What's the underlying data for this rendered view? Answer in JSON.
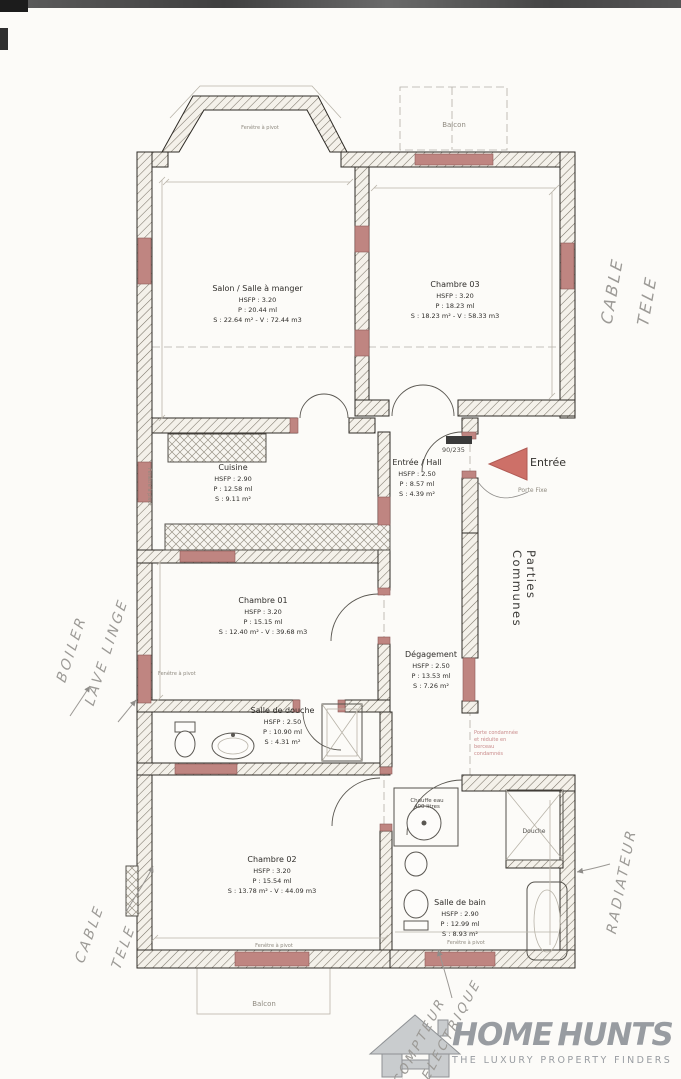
{
  "plan": {
    "rooms": [
      {
        "name": "Salon / Salle à manger",
        "hsfp": "HSFP : 3.20",
        "p": "P : 20.44 ml",
        "sv": "S : 22.64 m² - V : 72.44 m3"
      },
      {
        "name": "Chambre 03",
        "hsfp": "HSFP : 3.20",
        "p": "P : 18.23 ml",
        "sv": "S : 18.23 m² - V : 58.33 m3"
      },
      {
        "name": "Cuisine",
        "hsfp": "HSFP : 2.90",
        "p": "P : 12.58 ml",
        "sv": "S : 9.11 m²"
      },
      {
        "name": "Entrée / Hall",
        "hsfp": "HSFP : 2.50",
        "p": "P : 8.57 ml",
        "sv": "S : 4.39 m²"
      },
      {
        "name": "Chambre 01",
        "hsfp": "HSFP : 3.20",
        "p": "P : 15.15 ml",
        "sv": "S : 12.40 m² - V : 39.68 m3"
      },
      {
        "name": "Dégagement",
        "hsfp": "HSFP : 2.50",
        "p": "P : 13.53 ml",
        "sv": "S : 7.26 m²"
      },
      {
        "name": "Salle de douche",
        "hsfp": "HSFP : 2.50",
        "p": "P : 10.90 ml",
        "sv": "S : 4.31 m²"
      },
      {
        "name": "Chambre 02",
        "hsfp": "HSFP : 3.20",
        "p": "P : 15.54 ml",
        "sv": "S : 13.78 m² - V : 44.09 m3"
      },
      {
        "name": "Salle de bain",
        "hsfp": "HSFP : 2.90",
        "p": "P : 12.99 ml",
        "sv": "S : 8.93 m²"
      }
    ],
    "labels": {
      "balcon_top": "Balcon",
      "balcon_bottom": "Balcon",
      "entree": "Entrée",
      "porte_fixe": "Porte Fixe",
      "door_dim": "90/235",
      "parties_communes": "Parties Communes",
      "chauffe_eau_1": "Chauffe eau",
      "chauffe_eau_2": "400 litres",
      "douche": "Douche",
      "fenetre": "Fenêtre à pivot",
      "note_pink_1": "Porte condamnée",
      "note_pink_2": "et réduite en berceau",
      "note_pink_3": "condamnés"
    },
    "annotations": {
      "cable_right_1": "CABLE",
      "cable_right_2": "TELE",
      "boiler": "BOILER",
      "lave_linge": "LAVE LINGE",
      "cable_bottom_1": "CABLE",
      "cable_bottom_2": "TELE",
      "radiateur": "RADIATEUR",
      "compteur_1": "COMPTEUR",
      "compteur_2": "ELECTRIQUE"
    },
    "colors": {
      "wall": "#2e2b26",
      "accent_pink": "#bf8581",
      "arrow_red": "#cd7068",
      "note_pink": "#c98b8b",
      "handwriting": "#9c9a96",
      "logo_gray": "#989ca1"
    }
  },
  "footer": {
    "brand_1": "HOME",
    "brand_2": "HUNTS",
    "tagline": "THE LUXURY PROPERTY FINDERS"
  }
}
